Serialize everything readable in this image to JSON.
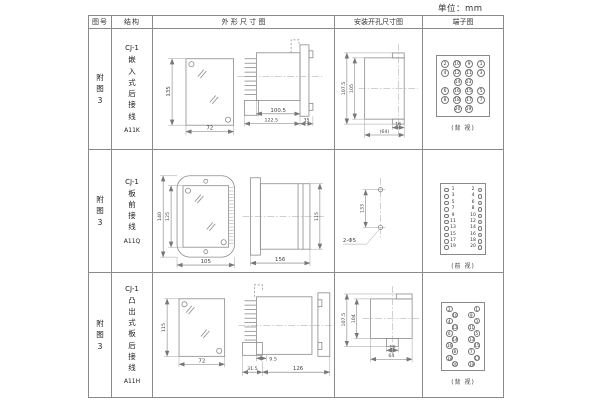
{
  "unit_label": "单位：mm",
  "table": {
    "headers": [
      "图号",
      "结构",
      "外 形 尺 寸 图",
      "安装开孔尺寸图",
      "端子图"
    ],
    "rows": [
      {
        "fig_no": "附\n图\n3",
        "model": "CJ-1",
        "mounting": "嵌\n入\n式\n后\n接\n线",
        "code": "A11K",
        "outline": {
          "front_height": "135",
          "front_width": "72",
          "body_len": "100.5",
          "overall_len": "122.5",
          "flange_depth": "35"
        },
        "install": {
          "outer_height": "107.5",
          "inner_height": "105",
          "hole_w": "16",
          "hole_span": "(64)"
        },
        "terminal": {
          "view": "(背 视)",
          "grid": [
            [
              "2",
              "10",
              "9",
              "1"
            ],
            [
              "4",
              "12",
              "11",
              "3"
            ],
            [
              "14",
              "13"
            ],
            [
              "6",
              "16",
              "15",
              "5"
            ],
            [
              "8",
              "18",
              "17",
              "7"
            ],
            [
              "20",
              "19"
            ]
          ]
        }
      },
      {
        "fig_no": "附\n图\n3",
        "model": "CJ-1",
        "mounting": "板\n前\n接\n线",
        "code": "A11Q",
        "outline": {
          "front_outer_height": "140",
          "front_inner_height": "125",
          "front_width": "105",
          "body_len": "156",
          "body_height": "115"
        },
        "install": {
          "hole_pitch": "133",
          "hole_note": "2-Φ5"
        },
        "terminal": {
          "view": "(前 视)",
          "pairs": [
            [
              "1",
              "2"
            ],
            [
              "3",
              "4"
            ],
            [
              "5",
              "6"
            ],
            [
              "7",
              "8"
            ],
            [
              "9",
              "10"
            ],
            [
              "11",
              "12"
            ],
            [
              "13",
              "14"
            ],
            [
              "15",
              "16"
            ],
            [
              "17",
              "18"
            ],
            [
              "19",
              "20"
            ]
          ]
        }
      },
      {
        "fig_no": "附\n图\n3",
        "model": "CJ-1",
        "mounting": "凸\n出\n式\n板\n后\n接\n线",
        "code": "A11H",
        "outline": {
          "front_height": "115",
          "front_width": "72",
          "base_w": "31.5",
          "pin_len": "9.5",
          "body_len": "126"
        },
        "install": {
          "outer_height": "107.5",
          "inner_height": "104",
          "hole_w": "16",
          "hole_span": "64"
        },
        "terminal": {
          "view": "(背 视)",
          "zigzag": [
            [
              "2",
              "1"
            ],
            [
              "10",
              "9"
            ],
            [
              "4",
              "3"
            ],
            [
              "12",
              "11"
            ],
            [
              "6",
              "5"
            ],
            [
              "14",
              "13"
            ],
            [
              "16",
              "15"
            ],
            [
              "8",
              "7"
            ],
            [
              "18",
              "17"
            ],
            [
              "20",
              "19"
            ]
          ]
        }
      }
    ]
  }
}
